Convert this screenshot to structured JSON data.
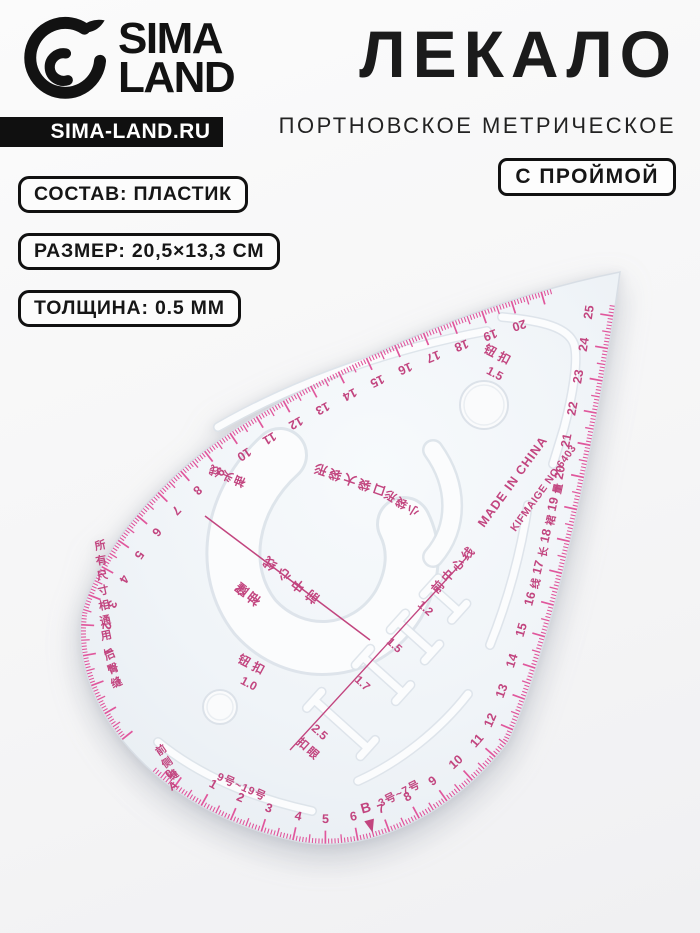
{
  "header": {
    "brand_line1": "SIMA",
    "brand_line2": "LAND",
    "site": "SIMA-LAND.RU",
    "title": "ЛЕКАЛО",
    "subtitle": "ПОРТНОВСКОЕ МЕТРИЧЕСКОЕ",
    "badge": "С ПРОЙМОЙ"
  },
  "specs": [
    "СОСТАВ: ПЛАСТИК",
    "РАЗМЕР: 20,5×13,3 СМ",
    "ТОЛЩИНА: 0.5 ММ"
  ],
  "ruler": {
    "colors": {
      "tick": "#e0579c",
      "ink": "#c2457f",
      "body": "#eef2f6"
    },
    "scales": {
      "outer_top_left": {
        "min": 1,
        "max": 20
      },
      "bottom_right": {
        "min": 1,
        "max": 25
      }
    },
    "origin_label": "0A",
    "b_marker": "B",
    "size_range_left": "9号~19号",
    "size_range_right": "3号~7号",
    "made_in": "MADE IN CHINA",
    "model": "KIFMAIGE NO.6403",
    "button_hole_large": {
      "label": "钮扣",
      "value": "1.5"
    },
    "button_hole_small": {
      "label": "钮扣",
      "value": "1.0"
    },
    "pocket_large": "口袋大袋形",
    "pocket_small": "小袋形",
    "center_line_1": "前中心线",
    "center_line_2": "前中心线",
    "armhole_label": "袖窿",
    "sleeve_head_line": "袖头线",
    "left_col_1": "所有尺寸相通用",
    "left_col_2": "后臀缝",
    "left_col_3": "前侧缝",
    "buttonhole_label": "扣眼",
    "buttonholes": [
      {
        "size": "1.2"
      },
      {
        "size": "1.5"
      },
      {
        "size": "1.7"
      },
      {
        "size": "2.5"
      }
    ],
    "edge_chars": "量裙长线"
  }
}
